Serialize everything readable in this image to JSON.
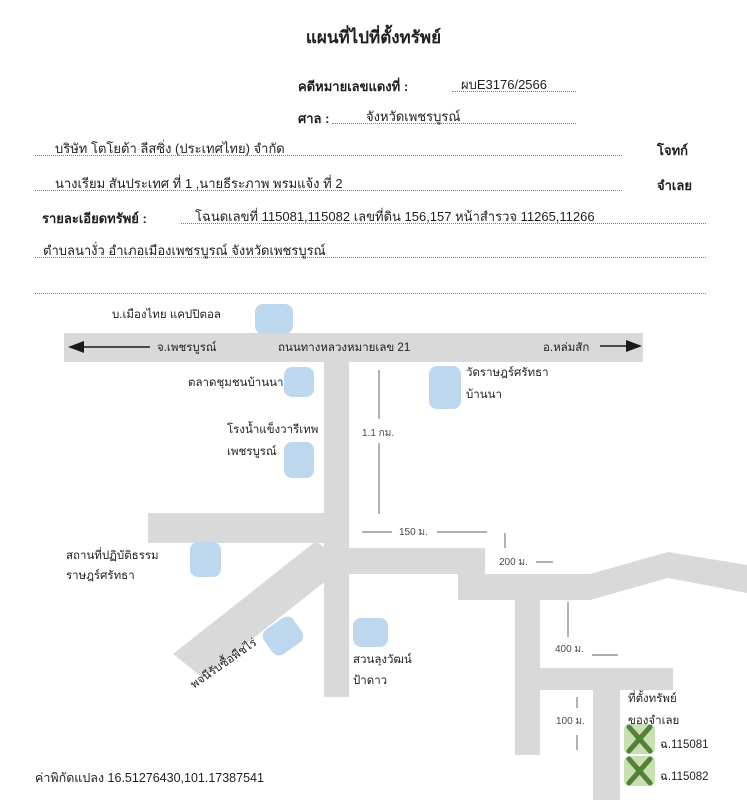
{
  "title": "แผนที่ไปที่ตั้งทรัพย์",
  "form": {
    "case_label": "คดีหมายเลขแดงที่ :",
    "case_value": "ผบE3176/2566",
    "court_label": "ศาล :",
    "court_value": "จังหวัดเพชรบูรณ์",
    "plaintiff_value": "บริษัท โตโยต้า ลีสซิ่ง (ประเทศไทย) จำกัด",
    "plaintiff_role": "โจทก์",
    "defendant_value": "นางเรียม สันประเทศ ที่ 1 ,นายธีระภาพ พรมแจ้ง ที่ 2",
    "defendant_role": "จำเลย",
    "property_label": "รายละเอียดทรัพย์ :",
    "property_line1": "โฉนดเลขที่ 115081,115082 เลขที่ดิน 156,157 หน้าสำรวจ 11265,11266",
    "property_line2": "ตำบลนางั่ว อำเภอเมืองเพชรบูรณ์ จังหวัดเพชรบูรณ์"
  },
  "map": {
    "highway_label": "ถนนทางหลวงหมายเลข 21",
    "direction_west": "จ.เพชรบูรณ์",
    "direction_east": "อ.หล่มสัก",
    "places": {
      "capital": "บ.เมืองไทย แคปปิตอล",
      "market": "ตลาดชุมชนบ้านนา",
      "ice_factory_line1": "โรงน้ำแข็งวารีเทพ",
      "ice_factory_line2": "เพชรบูรณ์",
      "temple_line1": "วัดราษฎร์ศรัทธา",
      "temple_line2": "บ้านนา",
      "dhamma_line1": "สถานที่ปฏิบัติธรรม",
      "dhamma_line2": "ราษฎร์ศรัทธา",
      "crop_buyer": "พจนีรับซื้อพืชไร่",
      "garden_line1": "สวนลุงวัฒน์",
      "garden_line2": "ป้าดาว"
    },
    "distances": {
      "highway_to_junction": "1.1 กม.",
      "junction_west": "150 ม.",
      "junction_east": "200 ม.",
      "south_road": "400 ม.",
      "last_road": "100 ม."
    },
    "property": {
      "line1": "ที่ตั้งทรัพย์",
      "line2": "ของจำเลย",
      "deed1": "ฉ.115081",
      "deed2": "ฉ.115082"
    },
    "colors": {
      "road": "#d9d9d9",
      "marker_blue": "#bdd7ee",
      "marker_green_fill": "#c6e0b4",
      "marker_green_x": "#538135",
      "measure_line": "#7f7f7f",
      "arrow": "#1a1a1a"
    }
  },
  "footer": {
    "coordinates": "ค่าพิกัดแปลง 16.51276430,101.17387541"
  }
}
